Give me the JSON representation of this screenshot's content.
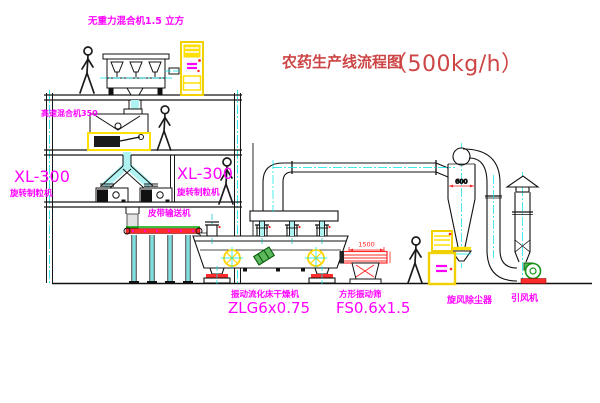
{
  "title": {
    "name": "农药生产线流程图",
    "capacity": "（500kg/h）"
  },
  "labels": {
    "gravity_mixer": "无重力混合机1.5 立方",
    "high_speed_mixer": "高速混合机350",
    "granulator_left": {
      "model": "XL-300",
      "name": "旋转制粒机"
    },
    "granulator_right": {
      "model": "XL-300",
      "name": "旋转制粒机"
    },
    "belt_conveyor": "皮带输送机",
    "dryer": {
      "name": "振动流化床干燥机",
      "model": "ZLG6x0.75"
    },
    "screen": {
      "name": "方形振动筛",
      "model": "FS0.6x1.5"
    },
    "cyclone": "旋风除尘器",
    "fan": "引风机"
  },
  "dimensions": {
    "screen_length": "1500",
    "cyclone_outlet": "600"
  },
  "colors": {
    "label_magenta": "#ff00ff",
    "title_red": "#cd4545",
    "dimension_red": "#ff2020",
    "cabinet_yellow": "#f0d000",
    "centerline_cyan": "#00e5e5",
    "conveyor_red": "#ff2a2a",
    "fan_green": "#169416"
  }
}
